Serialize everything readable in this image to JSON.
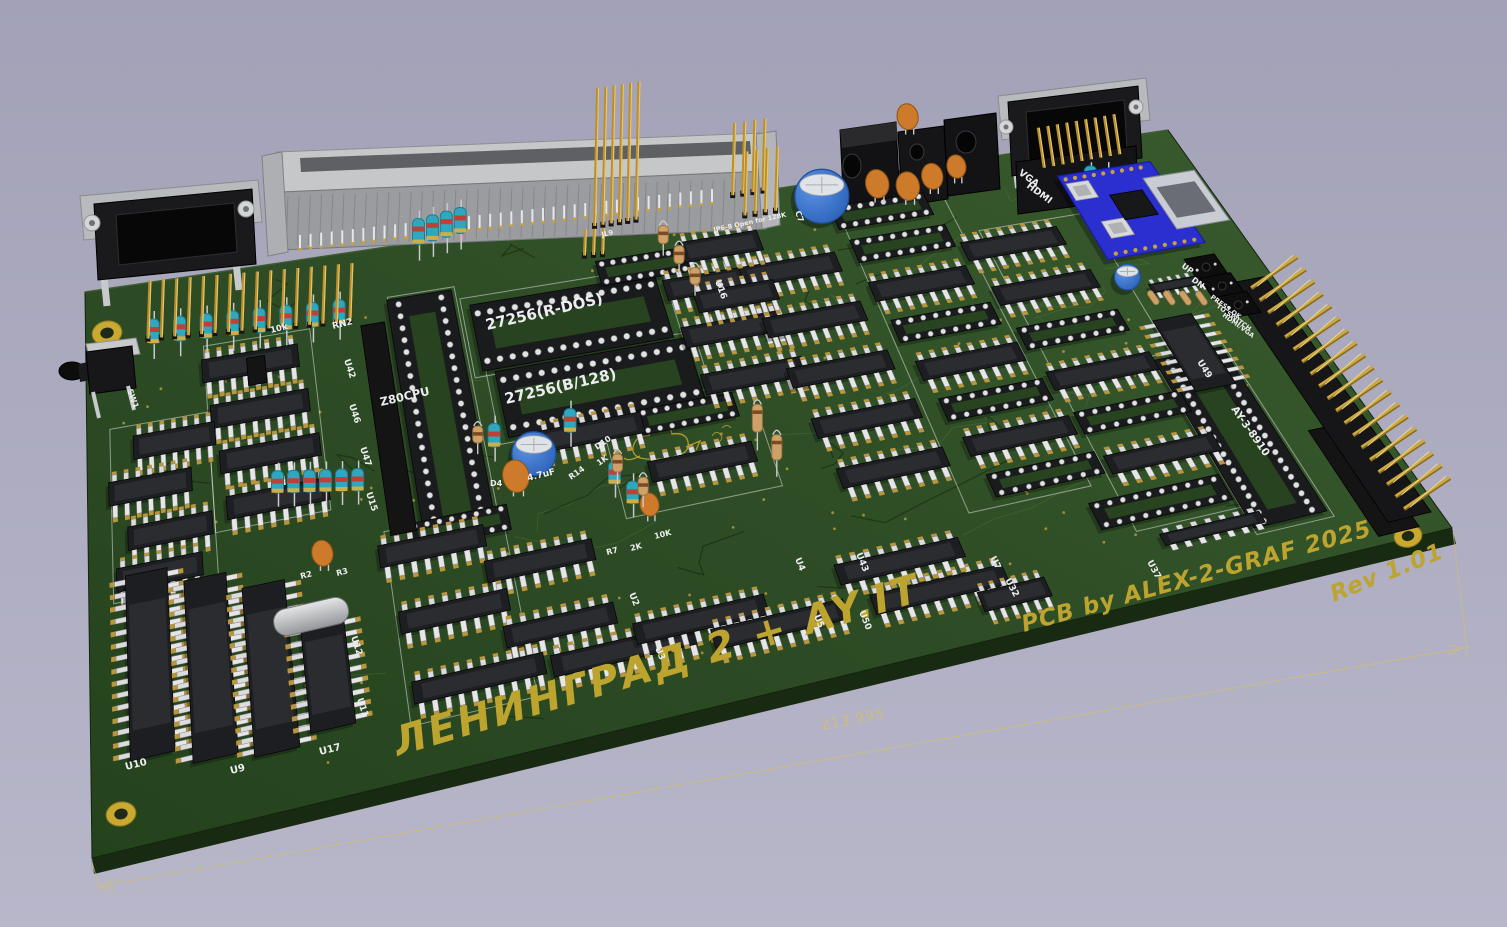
{
  "scene": {
    "background": {
      "top": "#a2a1b7",
      "bottom": "#b8b7ca"
    },
    "board": {
      "surface_dark": "#24431d",
      "surface": "#2e4d26",
      "surface_light": "#3a5c2e",
      "edge_side": "#182a11",
      "edge_left": "#1c2f15",
      "bevel": "#4e6f3e",
      "silk_white": "#ecedee",
      "silk_yellow": "#bda42f",
      "dimension": "#cdbd7e",
      "gold": "#c9a23b",
      "module_blue": "#2b2fd0"
    },
    "texts": [
      {
        "t": "ЛЕНИНГРАД 2 + AY.IT",
        "x": 398,
        "y": 756,
        "r": -16.5,
        "s": 40,
        "k": "big"
      },
      {
        "t": "PCB by ALEX-2-GRAF 2025",
        "x": 1024,
        "y": 632,
        "r": -15.5,
        "s": 23,
        "k": "credit"
      },
      {
        "t": "Rev 1.01",
        "x": 1334,
        "y": 602,
        "r": -22,
        "s": 23,
        "k": "credit"
      },
      {
        "t": "213.995",
        "x": 822,
        "y": 730,
        "r": -11,
        "s": 14,
        "k": "dim"
      },
      {
        "t": "27256(R-DOS)",
        "x": 487,
        "y": 330,
        "r": -13,
        "s": 15,
        "k": "silk"
      },
      {
        "t": "27256(B/128)",
        "x": 506,
        "y": 404,
        "r": -13,
        "s": 15,
        "k": "silk"
      },
      {
        "t": "Z80CPU",
        "x": 381,
        "y": 406,
        "r": -13,
        "s": 11.5,
        "k": "silk"
      },
      {
        "t": "AY-3-8910",
        "x": 1231,
        "y": 409,
        "r": 55,
        "s": 10.5,
        "k": "silk"
      },
      {
        "t": "VGA",
        "x": 1018,
        "y": 174,
        "r": 36,
        "s": 9.5,
        "k": "silk"
      },
      {
        "t": "HDMI",
        "x": 1026,
        "y": 187,
        "r": 36,
        "s": 9.5,
        "k": "silk"
      },
      {
        "t": "UP",
        "x": 1181,
        "y": 267,
        "r": 36,
        "s": 8,
        "k": "silk"
      },
      {
        "t": "DN",
        "x": 1191,
        "y": 281,
        "r": 36,
        "s": 8,
        "k": "silk"
      },
      {
        "t": "PRESS OK",
        "x": 1210,
        "y": 298,
        "r": 36,
        "s": 6.5,
        "k": "silk"
      },
      {
        "t": "TO SWITCH",
        "x": 1216,
        "y": 307,
        "r": 36,
        "s": 6.5,
        "k": "silk"
      },
      {
        "t": "HDMI/VGA",
        "x": 1222,
        "y": 316,
        "r": 36,
        "s": 6.5,
        "k": "silk"
      },
      {
        "t": "JP6-8 Open for 128K",
        "x": 714,
        "y": 232,
        "r": -12,
        "s": 6.5,
        "k": "silk"
      },
      {
        "t": "JL9",
        "x": 602,
        "y": 237,
        "r": -12,
        "s": 7,
        "k": "silk"
      },
      {
        "t": "4.7uF",
        "x": 528,
        "y": 481,
        "r": -14,
        "s": 9,
        "k": "silk"
      },
      {
        "t": "U10",
        "x": 126,
        "y": 770,
        "r": -14,
        "s": 10,
        "k": "ref"
      },
      {
        "t": "U9",
        "x": 231,
        "y": 774,
        "r": -14,
        "s": 10,
        "k": "ref"
      },
      {
        "t": "U17",
        "x": 320,
        "y": 755,
        "r": -14,
        "s": 10,
        "k": "ref"
      },
      {
        "t": "U15",
        "x": 366,
        "y": 493,
        "r": 72,
        "s": 9,
        "k": "ref"
      },
      {
        "t": "U47",
        "x": 360,
        "y": 448,
        "r": 72,
        "s": 9,
        "k": "ref"
      },
      {
        "t": "U42",
        "x": 344,
        "y": 360,
        "r": 72,
        "s": 9,
        "k": "ref"
      },
      {
        "t": "U46",
        "x": 349,
        "y": 405,
        "r": 72,
        "s": 9,
        "k": "ref"
      },
      {
        "t": "U12",
        "x": 351,
        "y": 637,
        "r": 72,
        "s": 9,
        "k": "ref"
      },
      {
        "t": "U11",
        "x": 357,
        "y": 699,
        "r": 72,
        "s": 9,
        "k": "ref"
      },
      {
        "t": "U2",
        "x": 629,
        "y": 594,
        "r": 68,
        "s": 9,
        "k": "ref"
      },
      {
        "t": "U3",
        "x": 655,
        "y": 648,
        "r": 68,
        "s": 9,
        "k": "ref"
      },
      {
        "t": "U4",
        "x": 795,
        "y": 559,
        "r": 68,
        "s": 9,
        "k": "ref"
      },
      {
        "t": "U5",
        "x": 814,
        "y": 616,
        "r": 68,
        "s": 9,
        "k": "ref"
      },
      {
        "t": "U50",
        "x": 859,
        "y": 612,
        "r": 68,
        "s": 9,
        "k": "ref"
      },
      {
        "t": "U43",
        "x": 856,
        "y": 554,
        "r": 68,
        "s": 9,
        "k": "ref"
      },
      {
        "t": "U16",
        "x": 715,
        "y": 281,
        "r": 70,
        "s": 9,
        "k": "ref"
      },
      {
        "t": "U32",
        "x": 1005,
        "y": 580,
        "r": 62,
        "s": 9,
        "k": "ref"
      },
      {
        "t": "U7",
        "x": 990,
        "y": 558,
        "r": 62,
        "s": 9,
        "k": "ref"
      },
      {
        "t": "U37",
        "x": 1147,
        "y": 562,
        "r": 62,
        "s": 9,
        "k": "ref"
      },
      {
        "t": "U49",
        "x": 1197,
        "y": 362,
        "r": 58,
        "s": 9,
        "k": "ref"
      },
      {
        "t": "RN2",
        "x": 333,
        "y": 329,
        "r": -14,
        "s": 9,
        "k": "ref"
      },
      {
        "t": "10k",
        "x": 271,
        "y": 333,
        "r": -14,
        "s": 8.5,
        "k": "ref"
      },
      {
        "t": "SW1",
        "x": 127,
        "y": 390,
        "r": 70,
        "s": 8,
        "k": "ref"
      },
      {
        "t": "C7",
        "x": 795,
        "y": 212,
        "r": 70,
        "s": 8,
        "k": "ref"
      },
      {
        "t": "R2",
        "x": 301,
        "y": 579,
        "r": -14,
        "s": 8,
        "k": "ref"
      },
      {
        "t": "R3",
        "x": 337,
        "y": 576,
        "r": -14,
        "s": 8,
        "k": "ref"
      },
      {
        "t": "R14",
        "x": 571,
        "y": 480,
        "r": -35,
        "s": 8,
        "k": "ref"
      },
      {
        "t": "1K",
        "x": 599,
        "y": 466,
        "r": -35,
        "s": 8,
        "k": "ref"
      },
      {
        "t": "D10",
        "x": 597,
        "y": 450,
        "r": -35,
        "s": 8,
        "k": "ref"
      },
      {
        "t": "D4",
        "x": 490,
        "y": 486,
        "r": 0,
        "s": 8,
        "k": "ref"
      },
      {
        "t": "R7",
        "x": 607,
        "y": 555,
        "r": -14,
        "s": 8,
        "k": "ref"
      },
      {
        "t": "2K",
        "x": 631,
        "y": 551,
        "r": -14,
        "s": 8,
        "k": "ref"
      },
      {
        "t": "10K",
        "x": 655,
        "y": 539,
        "r": -14,
        "s": 8,
        "k": "ref"
      }
    ],
    "chips": [
      [
        0.145,
        0.175
      ],
      [
        0.15,
        0.26
      ],
      [
        0.155,
        0.345
      ],
      [
        0.158,
        0.43
      ],
      [
        0.075,
        0.29,
        0.07
      ],
      [
        0.053,
        0.365,
        0.07
      ],
      [
        0.068,
        0.45,
        0.07
      ],
      [
        0.058,
        0.52,
        0.07
      ],
      [
        0.047,
        0.68,
        0.034,
        0.33,
        1
      ],
      [
        0.094,
        0.71,
        0.034,
        0.33,
        1
      ],
      [
        0.14,
        0.735,
        0.034,
        0.31,
        1
      ],
      [
        0.183,
        0.77,
        0.034,
        0.2,
        1
      ],
      [
        0.276,
        0.575
      ],
      [
        0.357,
        0.645
      ],
      [
        0.285,
        0.705
      ],
      [
        0.362,
        0.775
      ],
      [
        0.295,
        0.84,
        0.1
      ],
      [
        0.405,
        0.85,
        0.11
      ],
      [
        0.465,
        0.825,
        0.1
      ],
      [
        0.52,
        0.87,
        0.1
      ],
      [
        0.64,
        0.875,
        0.1
      ],
      [
        0.62,
        0.8,
        0.095
      ],
      [
        0.42,
        0.42
      ],
      [
        0.5,
        0.52
      ],
      [
        0.555,
        0.17
      ],
      [
        0.558,
        0.27
      ],
      [
        0.562,
        0.37
      ],
      [
        0.623,
        0.17
      ],
      [
        0.627,
        0.28
      ],
      [
        0.632,
        0.39
      ],
      [
        0.637,
        0.5
      ],
      [
        0.642,
        0.61
      ],
      [
        0.572,
        0.1,
        0.07
      ],
      [
        0.57,
        0.205,
        0.07
      ],
      [
        0.725,
        0.245
      ],
      [
        0.735,
        0.425
      ],
      [
        0.745,
        0.6
      ],
      [
        0.815,
        0.195
      ],
      [
        0.822,
        0.3
      ],
      [
        0.83,
        0.5
      ],
      [
        0.84,
        0.7
      ],
      [
        0.69,
        0.92,
        0.05
      ],
      [
        0.845,
        0.88,
        0.075,
        0.026,
        0,
        1
      ],
      [
        0.905,
        0.5,
        0.032,
        0.17,
        1
      ],
      [
        0.925,
        0.345,
        0.045,
        0.02,
        0,
        1
      ]
    ],
    "sockets": [
      [
        0.3,
        0.33,
        0.058,
        0.46,
        1,
        2
      ],
      [
        0.425,
        0.2,
        0.165,
        0.13,
        0,
        1
      ],
      [
        0.435,
        0.335,
        0.165,
        0.13,
        0,
        1
      ],
      [
        0.9,
        0.7,
        0.055,
        0.4,
        1,
        2
      ],
      [
        0.82,
        0.8,
        0.1,
        0.06,
        0,
        0
      ],
      [
        0.72,
        0.08,
        0.085,
        0.05,
        0,
        0
      ],
      [
        0.725,
        0.155,
        0.085,
        0.05,
        0,
        0
      ],
      [
        0.73,
        0.335,
        0.085,
        0.05,
        0,
        0
      ],
      [
        0.74,
        0.515,
        0.085,
        0.05,
        0,
        0
      ],
      [
        0.75,
        0.69,
        0.085,
        0.05,
        0,
        0
      ],
      [
        0.825,
        0.4,
        0.085,
        0.05,
        0,
        0
      ],
      [
        0.835,
        0.6,
        0.085,
        0.05,
        0,
        0
      ],
      [
        0.5,
        0.42,
        0.08,
        0.05,
        0,
        0
      ],
      [
        0.3,
        0.55,
        0.08,
        0.05,
        0,
        0
      ],
      [
        0.5,
        0.115,
        0.08,
        0.05,
        0,
        0
      ]
    ],
    "caps_blue": [
      {
        "u": 0.675,
        "v": 0.03,
        "r": 27
      },
      {
        "u": 0.37,
        "v": 0.44,
        "r": 22
      },
      {
        "u": 0.89,
        "v": 0.31,
        "r": 13
      }
    ],
    "caps_orange": [
      [
        0.352,
        0.5,
        1.25
      ],
      [
        0.19,
        0.565,
        1
      ],
      [
        0.45,
        0.6,
        0.9
      ],
      [
        0.725,
        0.045,
        1.1
      ],
      [
        0.75,
        0.06,
        1.1
      ],
      [
        0.775,
        0.045,
        1
      ],
      [
        0.8,
        0.03,
        0.9
      ],
      [
        0.78,
        -0.09,
        1
      ]
    ],
    "res_cyan": [
      [
        0.06,
        0.138,
        40
      ],
      [
        0.0835,
        0.141,
        40
      ],
      [
        0.107,
        0.144,
        40
      ],
      [
        0.1305,
        0.147,
        40
      ],
      [
        0.154,
        0.15,
        40
      ],
      [
        0.1775,
        0.153,
        40
      ],
      [
        0.201,
        0.156,
        40
      ],
      [
        0.2245,
        0.159,
        40
      ],
      [
        0.157,
        0.445,
        36
      ],
      [
        0.17,
        0.45,
        36
      ],
      [
        0.183,
        0.455,
        36
      ],
      [
        0.196,
        0.46,
        36
      ],
      [
        0.209,
        0.465,
        36
      ],
      [
        0.222,
        0.47,
        36
      ],
      [
        0.337,
        0.44,
        38
      ],
      [
        0.4,
        0.44,
        38
      ],
      [
        0.425,
        0.555,
        36
      ],
      [
        0.435,
        0.6,
        36
      ],
      [
        0.9,
        0.12,
        30
      ],
      [
        0.912,
        0.135,
        30
      ],
      [
        0.305,
        0.035,
        42
      ],
      [
        0.318,
        0.032,
        42
      ],
      [
        0.331,
        0.029,
        42
      ],
      [
        0.344,
        0.026,
        42
      ]
    ],
    "res_tan": [
      [
        0.43,
        0.53,
        30
      ],
      [
        0.445,
        0.585,
        30
      ],
      [
        0.325,
        0.42,
        28
      ],
      [
        0.545,
        0.52,
        46
      ],
      [
        0.553,
        0.58,
        42
      ],
      [
        0.52,
        0.1,
        30
      ],
      [
        0.528,
        0.145,
        30
      ],
      [
        0.536,
        0.19,
        28
      ]
    ],
    "res_tan_flat": [
      [
        0.9,
        0.365
      ],
      [
        0.912,
        0.372
      ],
      [
        0.924,
        0.379
      ],
      [
        0.936,
        0.386
      ],
      [
        0.948,
        0.393
      ]
    ],
    "buttons": [
      {
        "u": 0.955,
        "v": 0.32
      },
      {
        "u": 0.9575,
        "v": 0.368
      },
      {
        "u": 0.96,
        "v": 0.416
      }
    ],
    "holes": [
      [
        107,
        333,
        15
      ],
      [
        121,
        814,
        15
      ],
      [
        1408,
        536,
        14
      ],
      [
        1093,
        207,
        11
      ]
    ],
    "module": {
      "u": 0.925,
      "v": 0.165,
      "du": 0.084,
      "dv": 0.2
    },
    "pin_headers": [
      {
        "n": 16,
        "u0": 0.056,
        "v0": 0.1,
        "u1": 0.236,
        "v1": 0.128,
        "h": 58,
        "lean": 2
      },
      {
        "n": 6,
        "u0": 0.468,
        "v0": 0.02,
        "u1": 0.506,
        "v1": 0.02,
        "h": 138,
        "lean": 3
      },
      {
        "n": 4,
        "u0": 0.598,
        "v0": 0.0,
        "u1": 0.626,
        "v1": 0.0,
        "h": 72,
        "lean": 2
      },
      {
        "n": 4,
        "u0": 0.602,
        "v0": 0.045,
        "u1": 0.63,
        "v1": 0.045,
        "h": 64,
        "lean": 2
      },
      {
        "n": 9,
        "u0": 0.876,
        "v0": 0.042,
        "u1": 0.946,
        "v1": 0.038,
        "h": 40,
        "lean": -6
      },
      {
        "n": 3,
        "u0": 0.452,
        "v0": 0.075,
        "u1": 0.468,
        "v1": 0.078,
        "h": 26,
        "lean": 1
      }
    ],
    "right_header": {
      "u": 0.978,
      "v0": 0.385,
      "v1": 0.935,
      "n": 19,
      "dx": 46,
      "dy": -31
    },
    "misc_black": [
      [
        0.142,
        0.165,
        0.158,
        0.215
      ],
      [
        0.95,
        0.72,
        0.98,
        0.98
      ],
      [
        0.245,
        0.14,
        0.266,
        0.54
      ]
    ]
  }
}
